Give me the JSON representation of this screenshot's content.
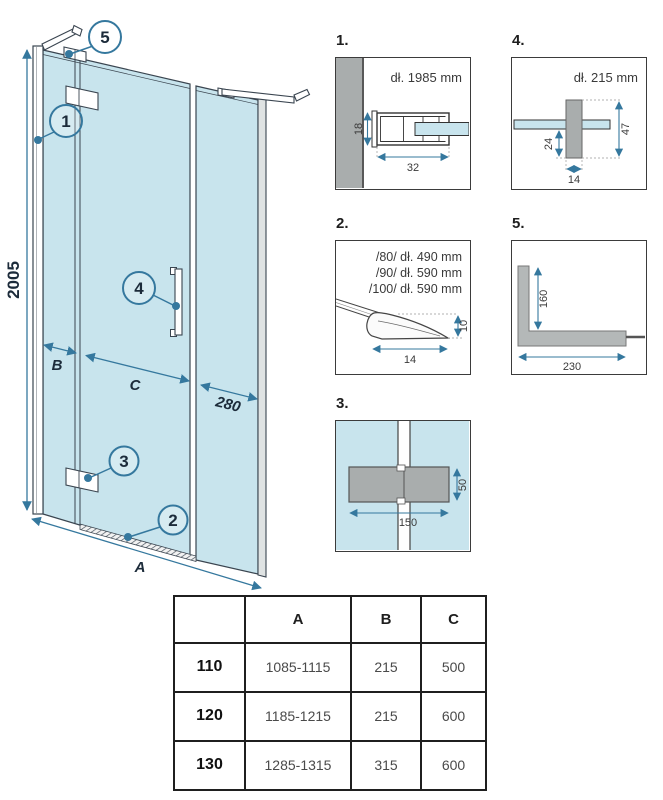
{
  "figure": {
    "main": {
      "height_label": "2005",
      "width_label": "A",
      "seg_left": "B",
      "seg_center": "C",
      "seg_right": "280",
      "callouts": {
        "c1": "1",
        "c2": "2",
        "c3": "3",
        "c4": "4",
        "c5": "5"
      }
    },
    "details": {
      "d1": {
        "index": "1.",
        "title": "dł. 1985 mm",
        "dim_height": "18",
        "dim_width": "32"
      },
      "d4": {
        "index": "4.",
        "title": "dł. 215 mm",
        "dim_total": "47",
        "dim_lower": "24",
        "dim_width": "14"
      },
      "d2": {
        "index": "2.",
        "variants": [
          "/80/ dł. 490 mm",
          "/90/ dł. 590 mm",
          "/100/ dł. 590 mm"
        ],
        "dim_height": "10",
        "dim_width": "14"
      },
      "d5": {
        "index": "5.",
        "dim_vertical": "160",
        "dim_horizontal": "230"
      },
      "d3": {
        "index": "3.",
        "dim_height": "50",
        "dim_width": "150"
      }
    }
  },
  "table": {
    "col_headers": [
      "A",
      "B",
      "C"
    ],
    "rows": [
      {
        "size": "110",
        "a": "1085-1115",
        "b": "215",
        "c": "500"
      },
      {
        "size": "120",
        "a": "1185-1215",
        "b": "215",
        "c": "600"
      },
      {
        "size": "130",
        "a": "1285-1315",
        "b": "315",
        "c": "600"
      }
    ]
  },
  "colors": {
    "glass": "#c8e4ed",
    "dimension_blue": "#35789e",
    "outline": "#3a4550",
    "label_ink": "#1c2b3a",
    "hardware_gray": "#a9adad"
  }
}
